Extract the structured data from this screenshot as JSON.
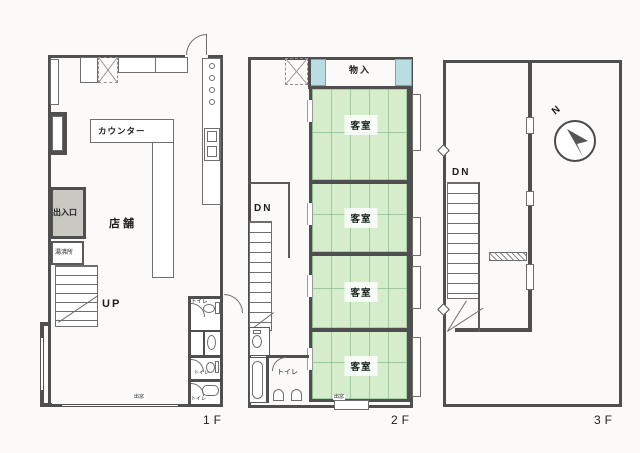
{
  "document": {
    "type": "floor-plan",
    "floors": 3
  },
  "colors": {
    "wall": "#4f4f4f",
    "paper": "#fbfaf8",
    "line": "#6e6e6e",
    "tatami": "#d6edcc",
    "tatami-line": "#8fbf96",
    "teal": "#b9dde0",
    "entry": "#c9c8c3"
  },
  "floor1": {
    "floor_label": "1F",
    "shop_label": "店舗",
    "counter_label": "カウンター",
    "entrance_label": "出入口",
    "utility_label": "湯沸所",
    "stairs_label": "UP",
    "bay_window_label": "出窓",
    "toilets": [
      {
        "label": "トイレ"
      },
      {
        "label": "トイレ"
      },
      {
        "label": "トイレ"
      }
    ]
  },
  "floor2": {
    "floor_label": "2F",
    "storage_label": "物入",
    "stairs_label": "DN",
    "toilet_label": "トイレ",
    "bay_window_label": "出窓",
    "rooms": [
      {
        "label": "客室"
      },
      {
        "label": "客室"
      },
      {
        "label": "客室"
      },
      {
        "label": "客室"
      }
    ]
  },
  "floor3": {
    "floor_label": "3F",
    "stairs_label": "DN",
    "compass_label": "N"
  }
}
